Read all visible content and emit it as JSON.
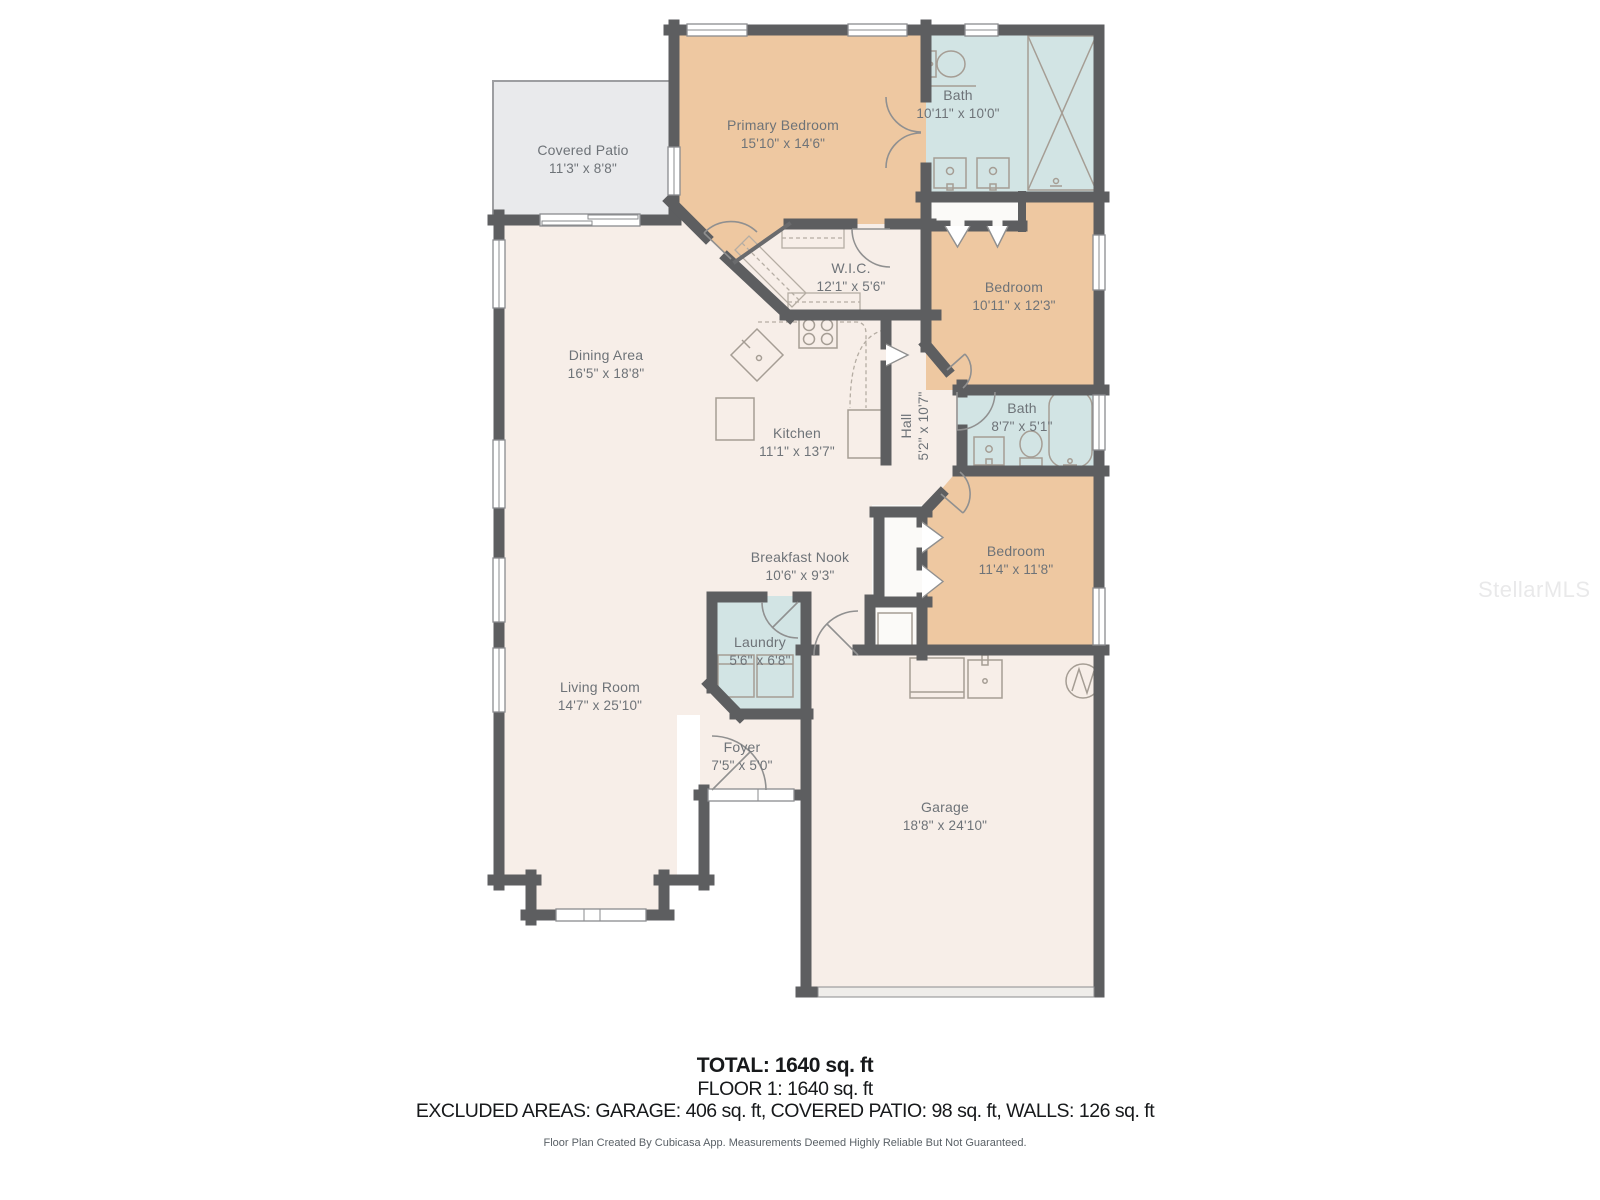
{
  "watermark": "StellarMLS",
  "rooms": [
    {
      "id": "covered-patio",
      "name": "Covered Patio",
      "dims": "11'3\" x 8'8\""
    },
    {
      "id": "primary-bedroom",
      "name": "Primary Bedroom",
      "dims": "15'10\" x 14'6\""
    },
    {
      "id": "bath-primary",
      "name": "Bath",
      "dims": "10'11\" x 10'0\""
    },
    {
      "id": "wic",
      "name": "W.I.C.",
      "dims": "12'1\" x 5'6\""
    },
    {
      "id": "bedroom-2",
      "name": "Bedroom",
      "dims": "10'11\" x 12'3\""
    },
    {
      "id": "dining-area",
      "name": "Dining Area",
      "dims": "16'5\" x 18'8\""
    },
    {
      "id": "kitchen",
      "name": "Kitchen",
      "dims": "11'1\" x 13'7\""
    },
    {
      "id": "hall",
      "name": "Hall",
      "dims": "5'2\" x 10'7\""
    },
    {
      "id": "bath-2",
      "name": "Bath",
      "dims": "8'7\" x 5'1\""
    },
    {
      "id": "bedroom-3",
      "name": "Bedroom",
      "dims": "11'4\" x 11'8\""
    },
    {
      "id": "breakfast-nook",
      "name": "Breakfast Nook",
      "dims": "10'6\" x 9'3\""
    },
    {
      "id": "laundry",
      "name": "Laundry",
      "dims": "5'6\" x 6'8\""
    },
    {
      "id": "living-room",
      "name": "Living Room",
      "dims": "14'7\" x 25'10\""
    },
    {
      "id": "foyer",
      "name": "Foyer",
      "dims": "7'5\" x 5'0\""
    },
    {
      "id": "garage",
      "name": "Garage",
      "dims": "18'8\" x 24'10\""
    }
  ],
  "summary": {
    "total": "TOTAL: 1640 sq. ft",
    "floor": "FLOOR 1: 1640 sq. ft",
    "excluded": "EXCLUDED AREAS: GARAGE: 406 sq. ft, COVERED PATIO: 98 sq. ft, WALLS: 126 sq. ft",
    "disclaimer": "Floor Plan Created By Cubicasa App. Measurements Deemed Highly Reliable But Not Guaranteed."
  },
  "colors": {
    "bedroom_fill": "#eec8a1",
    "bath_fill": "#d2e4e4",
    "living_fill": "#f7eee8",
    "patio_fill": "#e9eaec",
    "closet_fill": "#fbfaf8",
    "wall": "#5d5e60",
    "label_text": "#6e7378"
  }
}
